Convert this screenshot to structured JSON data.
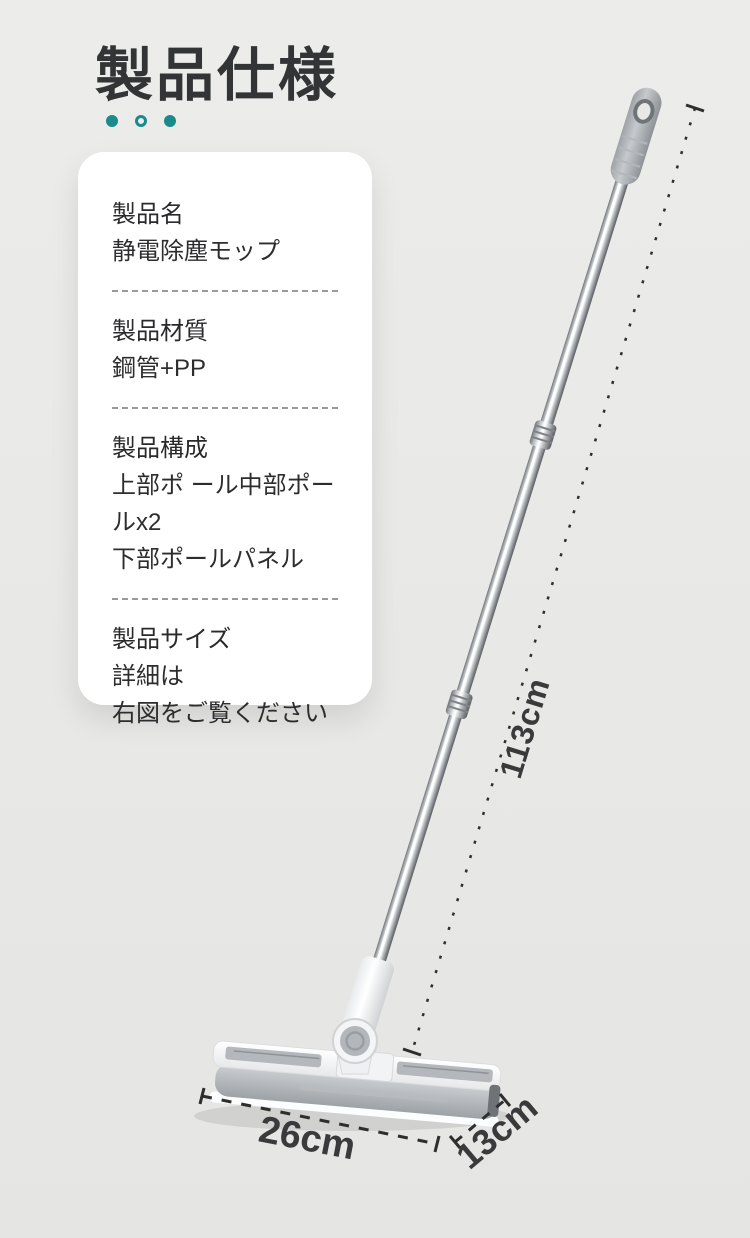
{
  "header": {
    "title": "製品仕様"
  },
  "accent": {
    "teal": "#1a8a8c"
  },
  "spec_card": {
    "sections": [
      {
        "label": "製品名",
        "lines": [
          "静電除塵モップ"
        ]
      },
      {
        "label": "製品材質",
        "lines": [
          "鋼管+PP"
        ]
      },
      {
        "label": "製品構成",
        "lines": [
          "上部ポ ール中部ポールx2",
          "下部ポールパネル"
        ]
      },
      {
        "label": "製品サイズ",
        "lines": [
          "詳細は",
          "右図をご覧ください"
        ]
      }
    ]
  },
  "dimensions": {
    "pole_length": "113cm",
    "head_width": "26cm",
    "head_depth": "13cm"
  },
  "illustration": {
    "subject": "electrostatic-dust-mop",
    "colors": {
      "steel": "#c2c6c9",
      "grip": "#a7aaae",
      "pad": "#a8adb2",
      "frame": "#f6f7f8"
    }
  }
}
